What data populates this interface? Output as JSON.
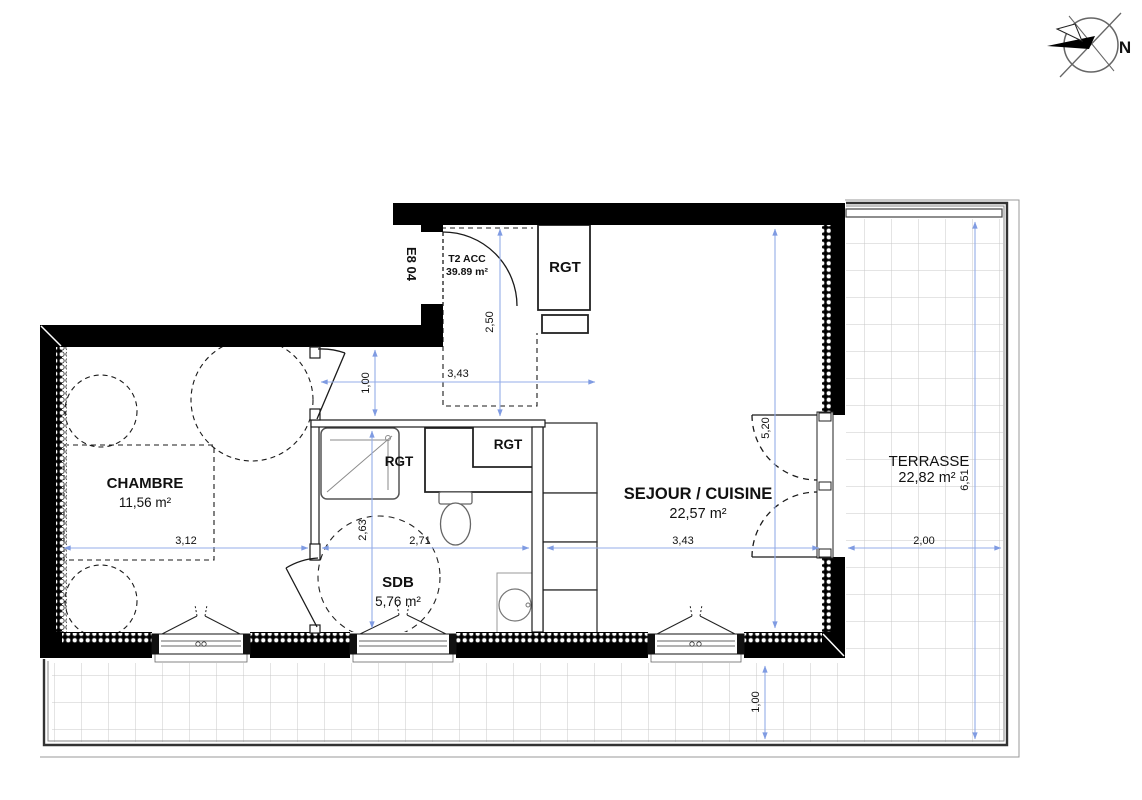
{
  "plan": {
    "unit": {
      "id": "E8 04",
      "type": "T2 ACC",
      "area": "39.89 m²"
    },
    "north": "N",
    "rooms": {
      "chambre": {
        "name": "CHAMBRE",
        "area": "11,56 m²"
      },
      "sdb": {
        "name": "SDB",
        "area": "5,76 m²"
      },
      "sejour": {
        "name": "SEJOUR / CUISINE",
        "area": "22,57 m²"
      },
      "terrasse": {
        "name": "TERRASSE",
        "area": "22,82 m²"
      }
    },
    "storage_label": "RGT",
    "dims": {
      "chambre_width": "3,12",
      "sdb_width": "2,71",
      "sejour_width": "3,43",
      "terrasse_width": "2,00",
      "hall_width": "3,43",
      "hall_depth": "2,50",
      "corridor_width": "1,00",
      "sdb_depth": "2,63",
      "sejour_depth": "5,20",
      "terrasse_strip_depth": "1,00",
      "terrasse_length": "6,51"
    },
    "colors": {
      "dimension_blue": "#94ace8",
      "unit_id_pink": "#e0467e",
      "wall_black": "#000000",
      "tile_grid_grey": "#c9c9c9"
    }
  }
}
